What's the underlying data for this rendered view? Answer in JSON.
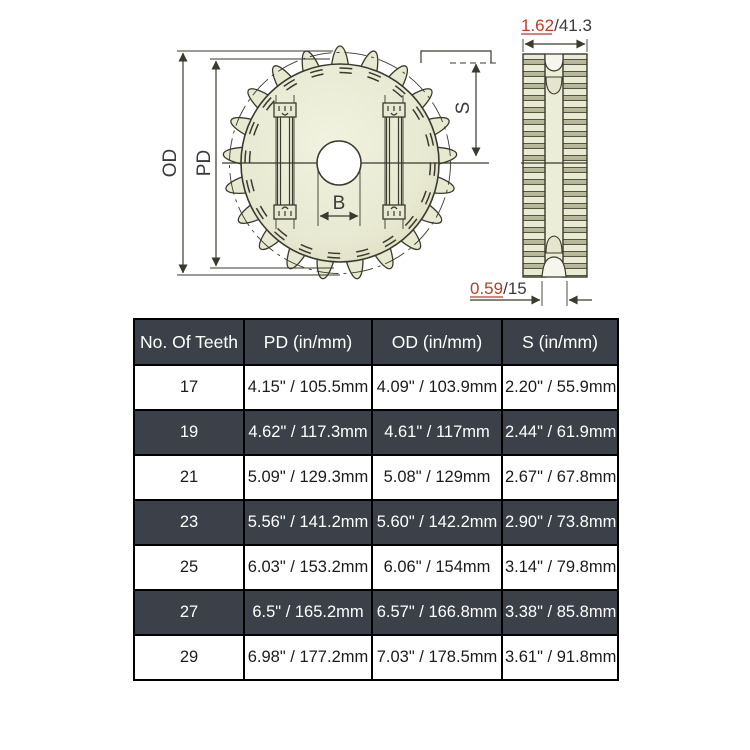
{
  "diagram": {
    "front": {
      "od_label": "OD",
      "pd_label": "PD",
      "b_label": "B",
      "s_label": "S"
    },
    "side": {
      "top_dim_in": "1.62",
      "top_dim_mm": "/41.3",
      "bottom_dim_in": "0.59",
      "bottom_dim_mm": "/15"
    },
    "colors": {
      "accent_red": "#c0392b",
      "line": "#3a3a2e",
      "body_fill": "#e8e9d1",
      "stripe_olive": "#b8b99a"
    }
  },
  "table": {
    "headers": [
      "No. Of Teeth",
      "PD (in/mm)",
      "OD (in/mm)",
      "S (in/mm)"
    ],
    "rows": [
      [
        "17",
        "4.15\" / 105.5mm",
        "4.09\" / 103.9mm",
        "2.20\" / 55.9mm"
      ],
      [
        "19",
        "4.62\" / 117.3mm",
        "4.61\" / 117mm",
        "2.44\" / 61.9mm"
      ],
      [
        "21",
        "5.09\" / 129.3mm",
        "5.08\" / 129mm",
        "2.67\" / 67.8mm"
      ],
      [
        "23",
        "5.56\" / 141.2mm",
        "5.60\" / 142.2mm",
        "2.90\" / 73.8mm"
      ],
      [
        "25",
        "6.03\" / 153.2mm",
        "6.06\" / 154mm",
        "3.14\" / 79.8mm"
      ],
      [
        "27",
        "6.5\" / 165.2mm",
        "6.57\" / 166.8mm",
        "3.38\" / 85.8mm"
      ],
      [
        "29",
        "6.98\" / 177.2mm",
        "7.03\" / 178.5mm",
        "3.61\" / 91.8mm"
      ]
    ],
    "colors": {
      "header_bg": "#3b4049",
      "header_text": "#ffffff",
      "alt_row_bg": "#3b4049",
      "row_bg": "#ffffff",
      "border": "#000000"
    }
  }
}
